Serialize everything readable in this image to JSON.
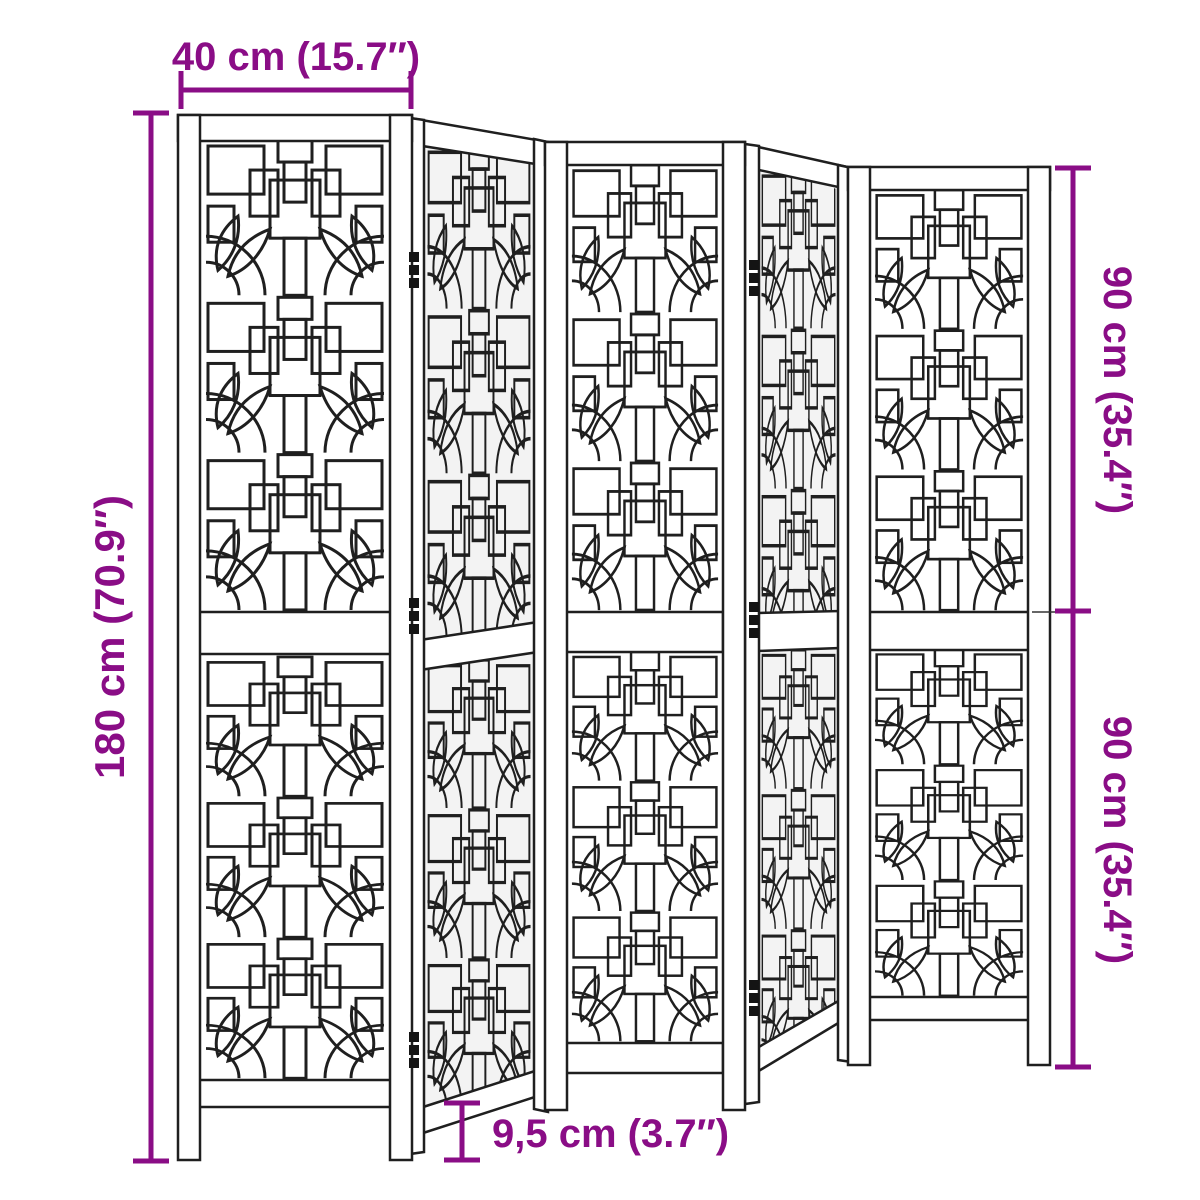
{
  "diagram": {
    "subject": "5-panel folding room divider with ornamental lattice",
    "panel_count": 5,
    "hinged_junctions": 2
  },
  "colors": {
    "dimension_accent": "#8A0D86",
    "linework": "#1F1F1F",
    "background": "#FFFFFF"
  },
  "dims": {
    "panel_width": {
      "label": "40 cm (15.7″)"
    },
    "total_height": {
      "label": "180 cm (70.9″)"
    },
    "upper_half": {
      "label": "90 cm (35.4″)"
    },
    "lower_half": {
      "label": "90 cm (35.4″)"
    },
    "leg_height": {
      "label": "9,5 cm (3.7″)"
    }
  }
}
